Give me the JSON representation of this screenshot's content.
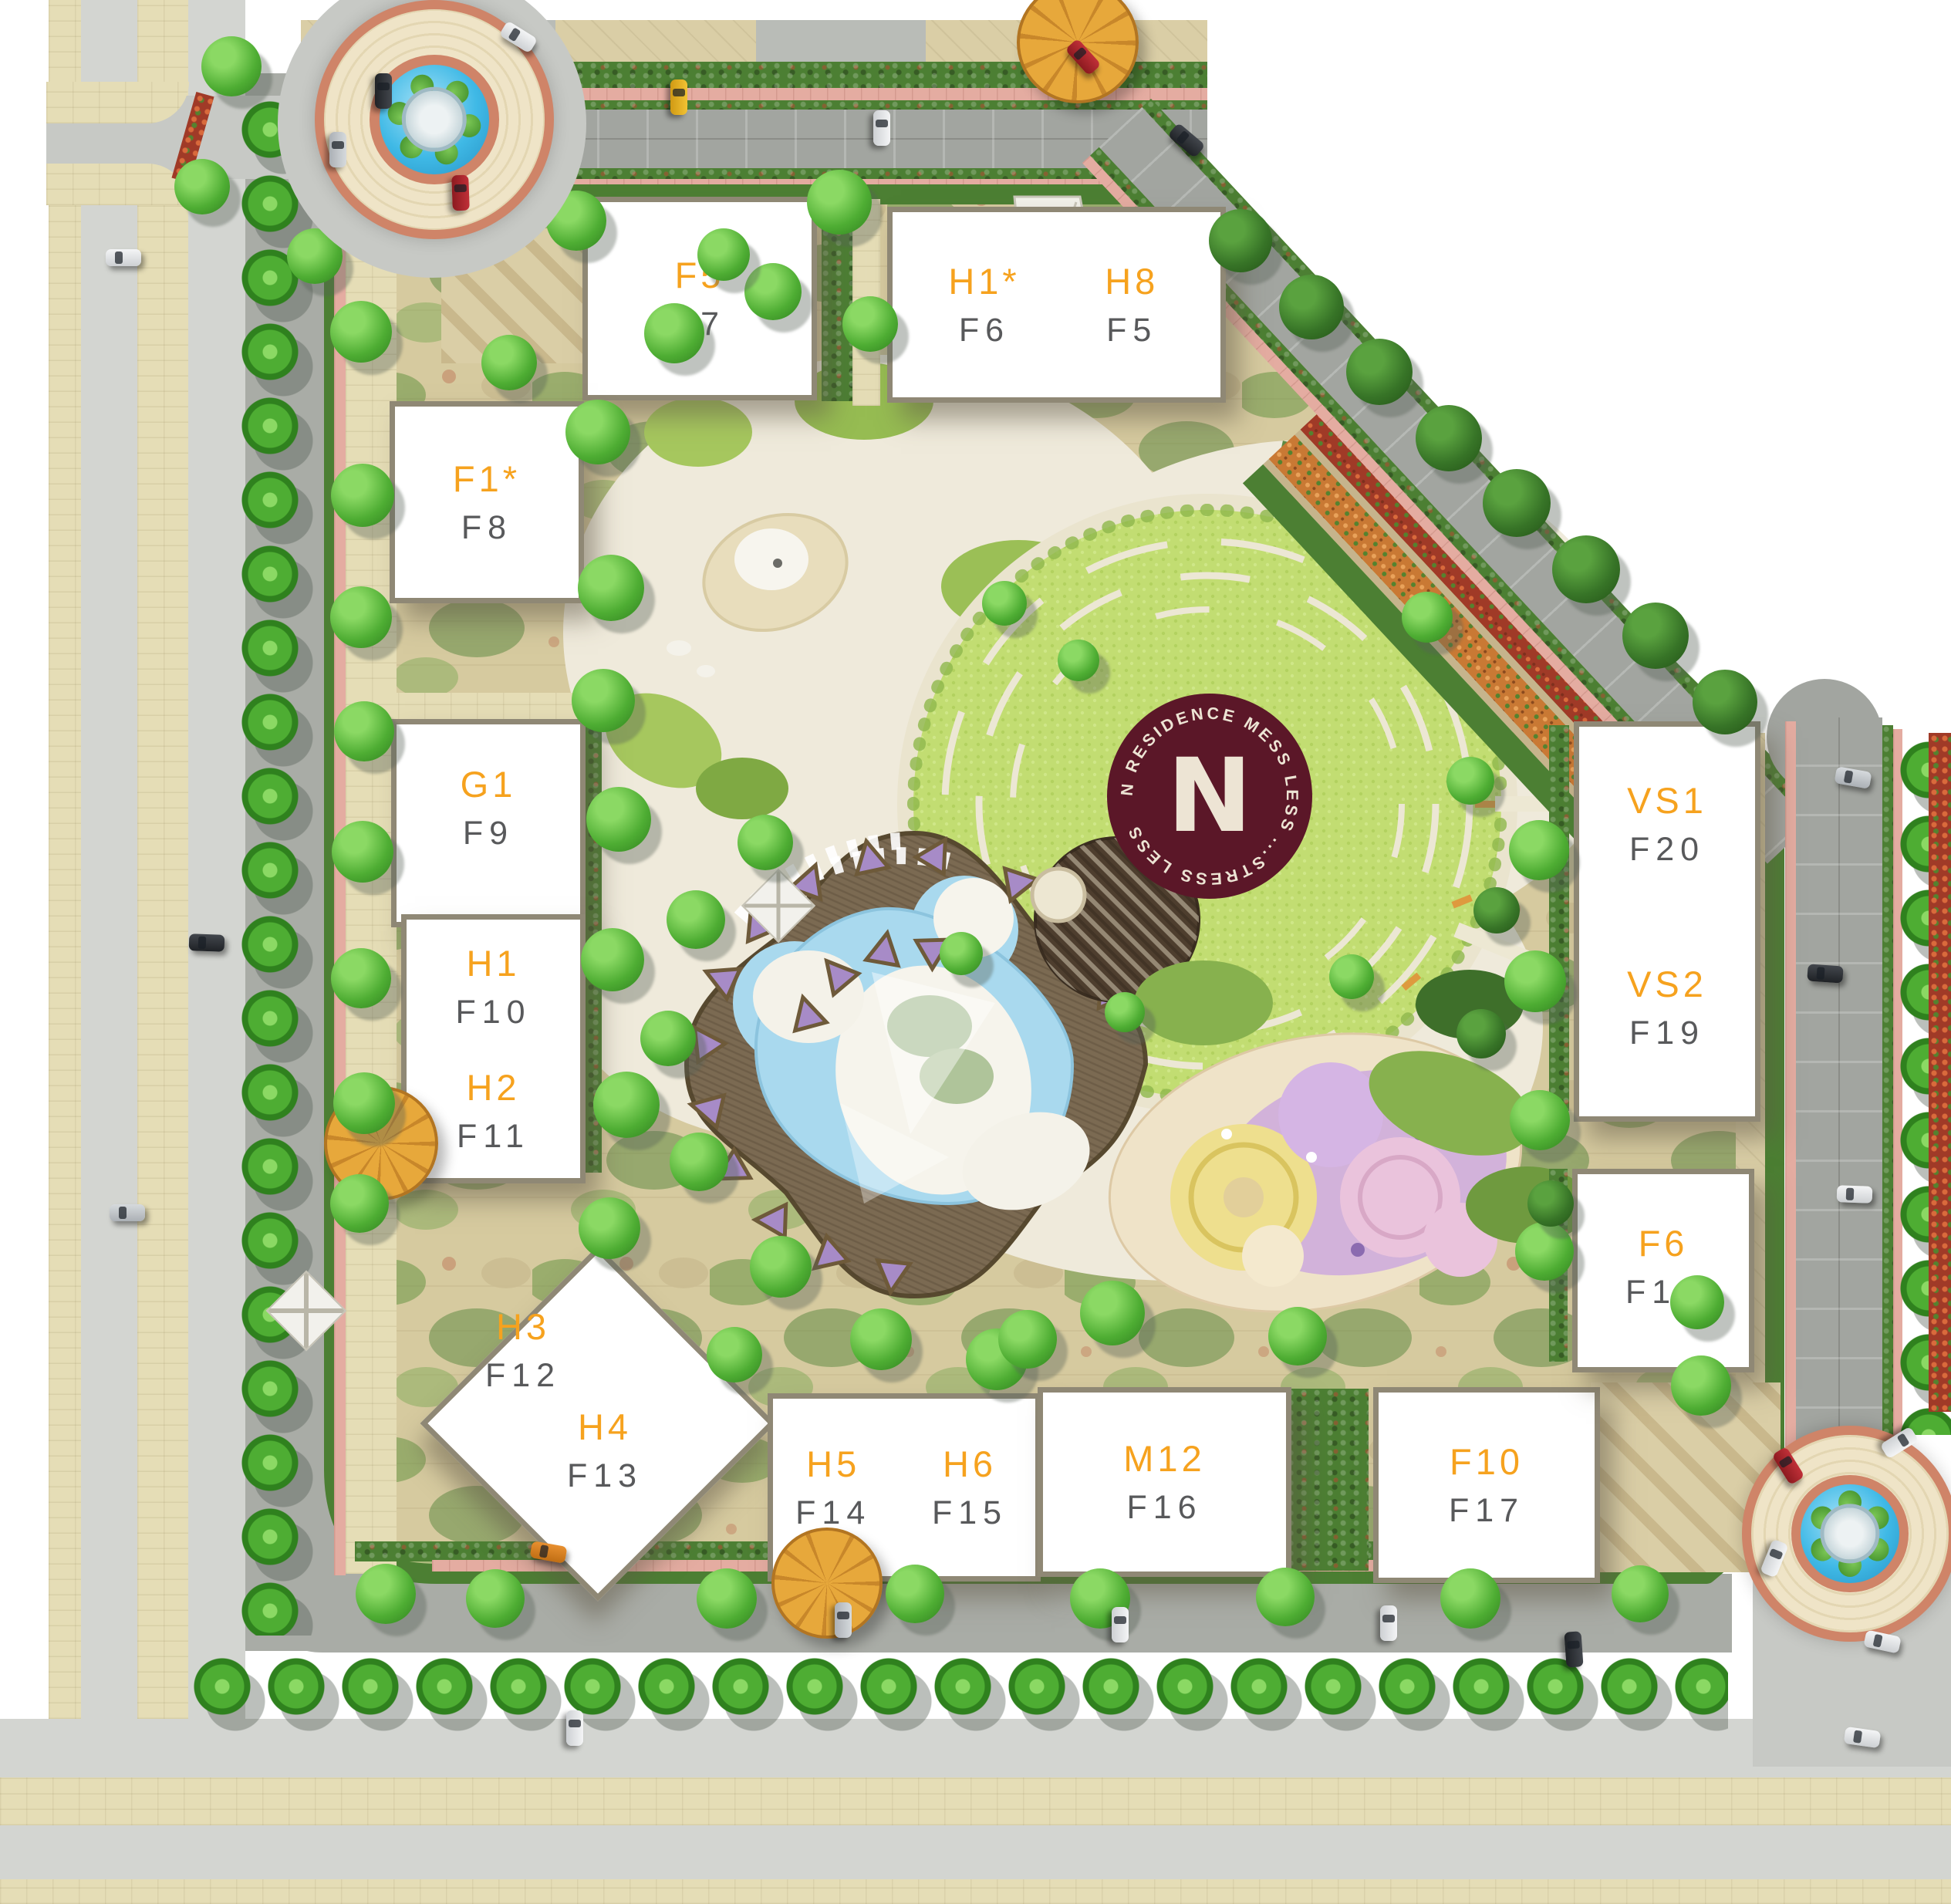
{
  "logo": {
    "letter": "N",
    "ring_text": "N RESIDENCE MESS LESS ...STRESS LESS ",
    "circle_color": "#5B1728",
    "text_color": "#EDE4D4"
  },
  "buildings": [
    {
      "code": "F5",
      "unit": "F7"
    },
    {
      "code": "H1*",
      "unit": "F6"
    },
    {
      "code": "H8",
      "unit": "F5"
    },
    {
      "code": "F1*",
      "unit": "F8"
    },
    {
      "code": "G1",
      "unit": "F9"
    },
    {
      "code": "H1",
      "unit": "F10"
    },
    {
      "code": "H2",
      "unit": "F11"
    },
    {
      "code": "H3",
      "unit": "F12"
    },
    {
      "code": "H4",
      "unit": "F13"
    },
    {
      "code": "H5",
      "unit": "F14"
    },
    {
      "code": "H6",
      "unit": "F15"
    },
    {
      "code": "M12",
      "unit": "F16"
    },
    {
      "code": "F10",
      "unit": "F17"
    },
    {
      "code": "F6",
      "unit": "F18"
    },
    {
      "code": "VS1",
      "unit": "F20"
    },
    {
      "code": "VS2",
      "unit": "F19"
    }
  ],
  "colors": {
    "building_code": "#F6A21E",
    "building_unit": "#58595B",
    "lawn": "#C2DD72",
    "pool": "#A9D9EE",
    "deck": "#7B6A52",
    "water": "#3FB9E6",
    "roundabout_ring": "#CF8468",
    "hedge": "#4C7F33",
    "site_paving": "#D6CA9F",
    "plaza": "#EFEADB",
    "road": "#A9ACA6",
    "sidewalk_pink": "#E4ACA1",
    "playground_pink": "#EAC3DC",
    "playground_purple": "#CDA9DD",
    "playground_yellow": "#EEDF8E",
    "cabana_purple": "#A78BC7"
  }
}
